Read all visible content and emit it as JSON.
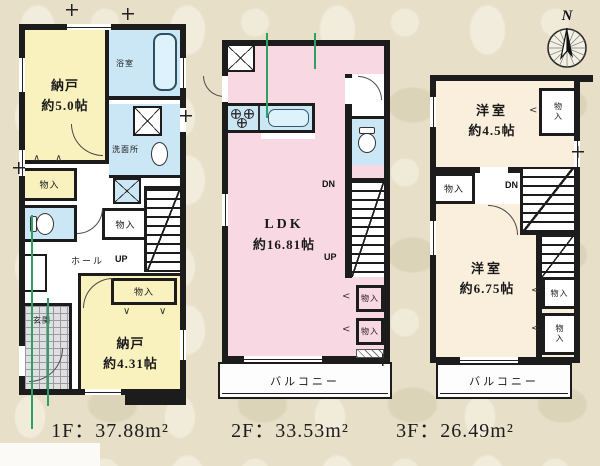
{
  "compass": {
    "label": "N"
  },
  "common": {
    "closet": "物入",
    "balcony": "バルコニー",
    "up": "UP",
    "down": "DN"
  },
  "floor1": {
    "storage_a": {
      "name": "納戸",
      "size": "約5.0帖"
    },
    "bathroom": "浴室",
    "washroom": "洗面所",
    "hall": "ホール",
    "entrance": "玄関",
    "storage_b": {
      "name": "納戸",
      "size": "約4.31帖"
    },
    "area": "1F：37.88m²"
  },
  "floor2": {
    "ldk": {
      "name": "LDK",
      "size": "約16.81帖"
    },
    "area": "2F：33.53m²"
  },
  "floor3": {
    "western_a": {
      "name": "洋室",
      "size": "約4.5帖"
    },
    "western_b": {
      "name": "洋室",
      "size": "約6.75帖"
    },
    "area": "3F：26.49m²"
  },
  "palette": {
    "wall": "#1c1c1c",
    "storage_yellow": "#f9f2bf",
    "wet_area_blue": "#cbe7f5",
    "ldk_pink": "#f8d8e2",
    "western_cream": "#faeedd",
    "survey_line_green": "#2fa065",
    "background_beige": "#e7dfc8"
  }
}
